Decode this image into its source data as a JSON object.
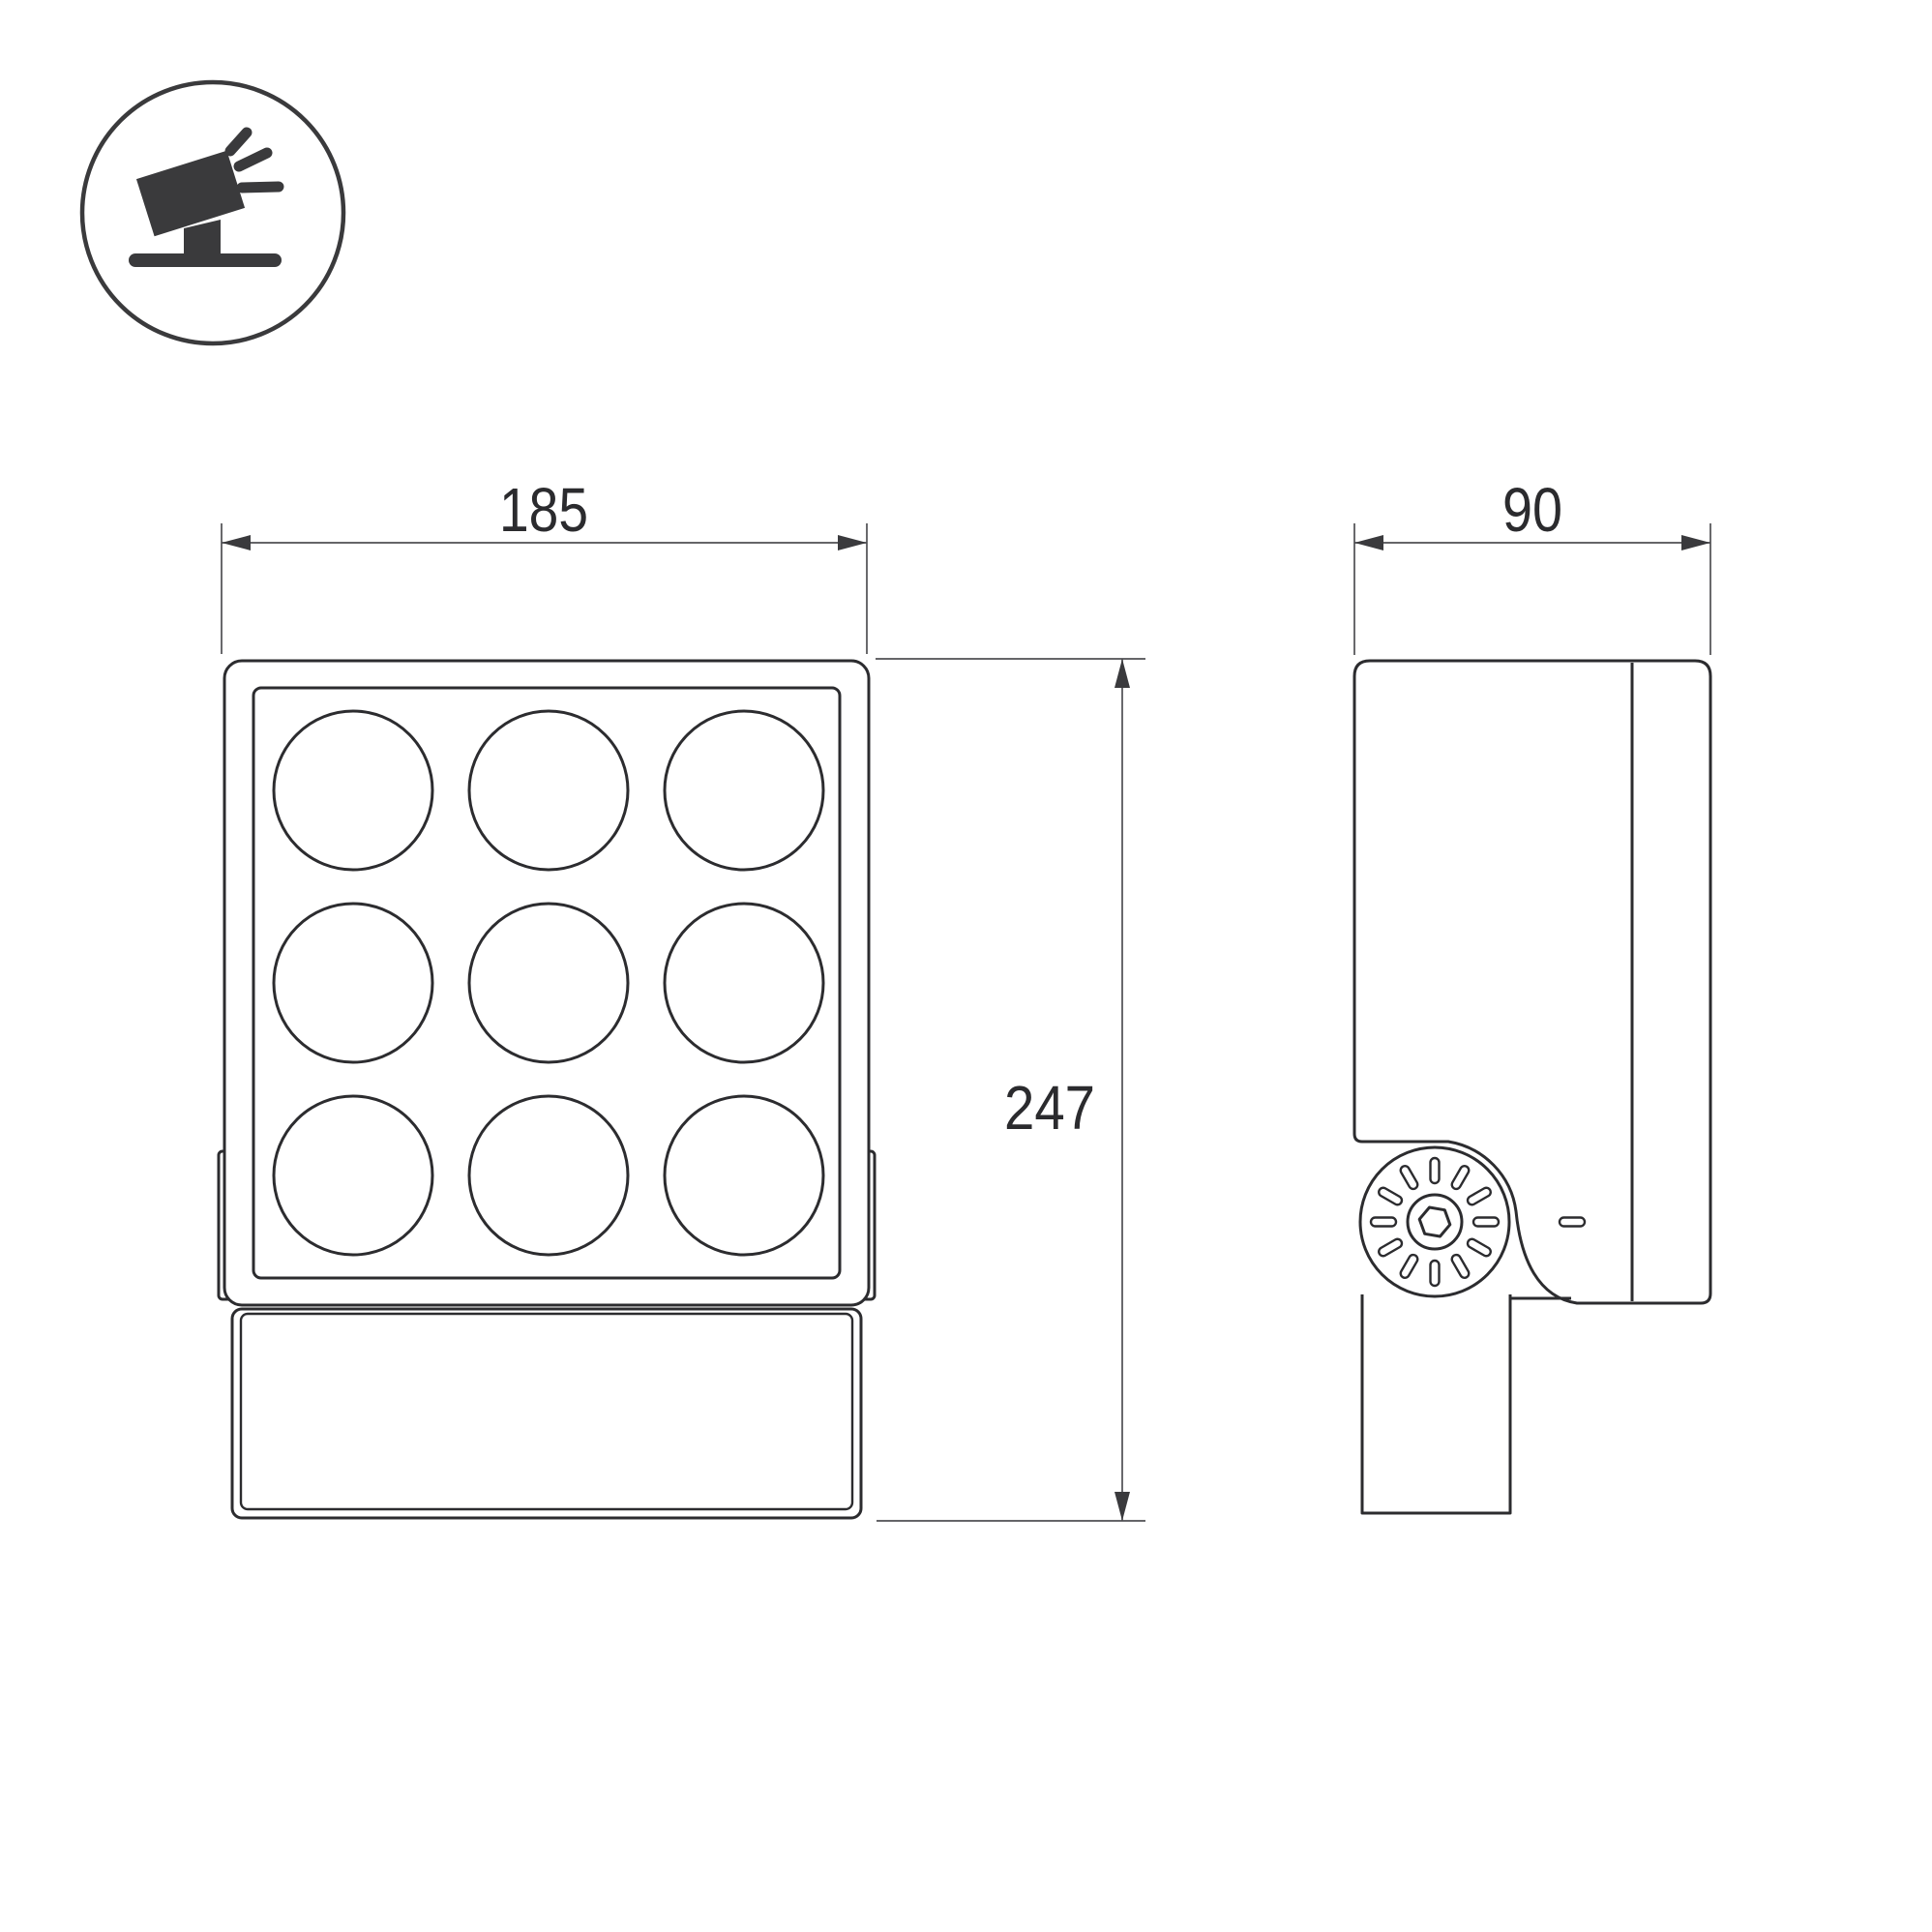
{
  "page": {
    "background": "#ffffff"
  },
  "icon": {
    "label": "tilted-floodlight"
  },
  "front_view": {
    "width_label": "185",
    "height_label": "247",
    "led_grid": {
      "rows": 3,
      "cols": 3
    }
  },
  "side_view": {
    "depth_label": "90",
    "knob_slot_count": 12
  },
  "colors": {
    "object_line": "#2c2c2f",
    "dimension_line": "#4f4f53",
    "arrow": "#3a3a3d",
    "text": "#2b2b2e",
    "icon": "#3a3a3c"
  }
}
